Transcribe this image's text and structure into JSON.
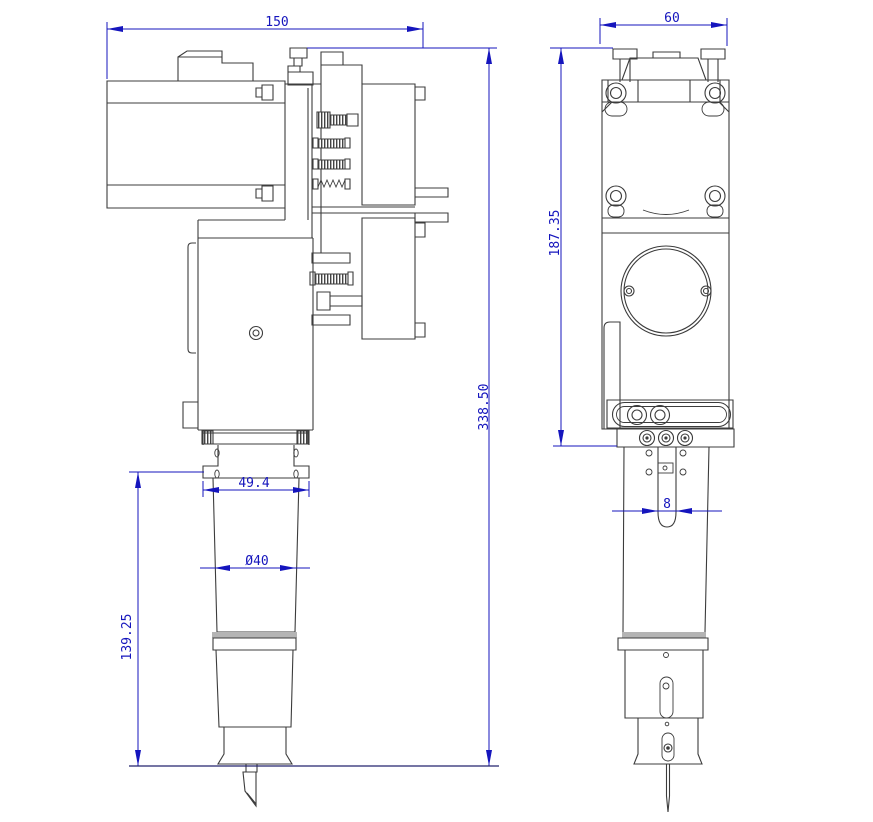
{
  "colors": {
    "dimension_blue": "#1515bd",
    "outline_gray": "#3c3c3c",
    "light_gray": "#b4b4b4",
    "baseline_navy": "#23236e",
    "background": "#ffffff"
  },
  "dimensions": {
    "overall_width": "150",
    "overall_depth": "60",
    "upper_height": "187.35",
    "overall_height": "338.50",
    "flange_width": "49.4",
    "barrel_diameter": "Ø40",
    "lower_height": "139.25",
    "slot_width": "8"
  }
}
